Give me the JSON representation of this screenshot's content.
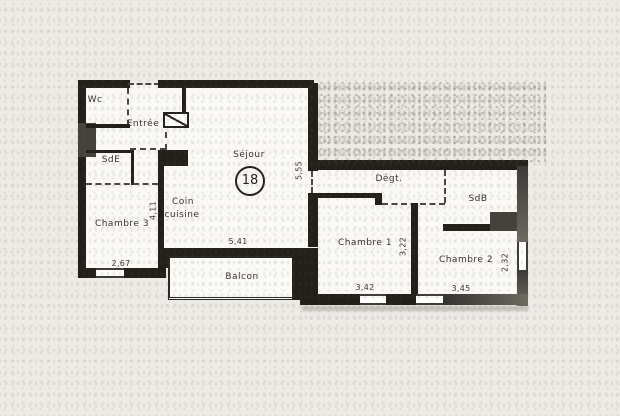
{
  "rooms": {
    "wc": {
      "label": "Wc"
    },
    "entree": {
      "label": "Entrée"
    },
    "sde": {
      "label": "SdE"
    },
    "chambre3": {
      "label": "Chambre 3"
    },
    "coin_cuisine": {
      "line1": "Coin",
      "line2": "cuisine"
    },
    "sejour": {
      "label": "Séjour",
      "number": "18"
    },
    "degt": {
      "label": "Dégt."
    },
    "sdb": {
      "label": "SdB"
    },
    "chambre1": {
      "label": "Chambre 1"
    },
    "chambre2": {
      "label": "Chambre 2"
    },
    "balcon": {
      "label": "Balcon"
    }
  },
  "dimensions": {
    "chambre3": {
      "width": "2,67",
      "height": "4,11"
    },
    "sejour": {
      "width": "5,41",
      "height": "5,55"
    },
    "chambre1": {
      "width": "3,42",
      "height": "3,22"
    },
    "chambre2": {
      "width": "3,45",
      "height": "2,32"
    }
  },
  "colors": {
    "wall": "#222019",
    "wall_gray": "#6e6a61",
    "paper": "#edebe6",
    "room": "#faf9f5",
    "text": "#35322e"
  }
}
